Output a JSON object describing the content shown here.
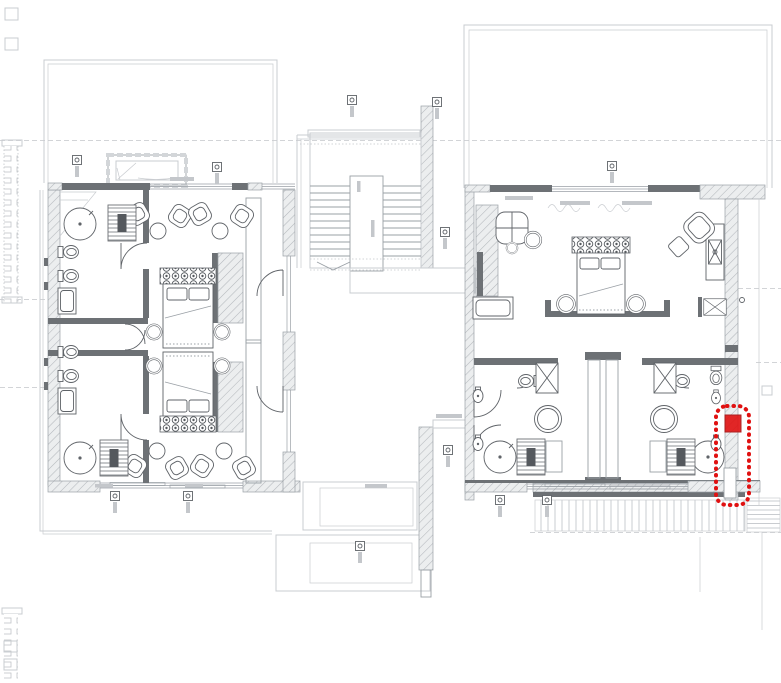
{
  "document": {
    "kind": "architectural floor plan (CAD, upper level, two bedroom wings with central staircase)",
    "background": "#ffffff"
  },
  "palette": {
    "outline_light": "#c9ccd0",
    "line_mid": "#9aa0a6",
    "wall_dark": "#6d7175",
    "hatch_line": "#b4b8bc",
    "furniture": "#5f6368",
    "dashed_ref": "#c3c6ca",
    "tag_fill": "#c4c7cb",
    "highlight_red": "#e01111"
  },
  "highlight": {
    "name": "highlighted-wall-segment",
    "style": "red dotted rounded outline with red filled marker square",
    "x": 716,
    "y": 406,
    "width": 33,
    "height": 99,
    "rx": 11,
    "marker_x": 725,
    "marker_y": 415,
    "marker_w": 16,
    "marker_h": 17
  },
  "plan": {
    "tags": [
      [
        77,
        160
      ],
      [
        217,
        167
      ],
      [
        352,
        100
      ],
      [
        437,
        102
      ],
      [
        612,
        166
      ],
      [
        445,
        232
      ],
      [
        448,
        450
      ],
      [
        115,
        496
      ],
      [
        188,
        496
      ],
      [
        360,
        546
      ],
      [
        500,
        500
      ],
      [
        547,
        500
      ]
    ],
    "chair_sets": [
      [
        160,
        222,
        0
      ],
      [
        222,
        222,
        0
      ],
      [
        155,
        460,
        180
      ],
      [
        222,
        460,
        180
      ]
    ],
    "toilets": [
      [
        70,
        252,
        -90
      ],
      [
        70,
        276,
        -90
      ],
      [
        70,
        352,
        -90
      ],
      [
        70,
        376,
        -90
      ],
      [
        527,
        381,
        90
      ],
      [
        681,
        381,
        -90
      ],
      [
        716,
        377,
        0,
        0.9
      ]
    ],
    "tubs": [
      [
        80,
        224
      ],
      [
        80,
        458
      ],
      [
        500,
        457
      ],
      [
        708,
        457
      ]
    ],
    "tables": [
      [
        548,
        419
      ],
      [
        664,
        419
      ],
      [
        154,
        332,
        0,
        0.6
      ],
      [
        222,
        332,
        0,
        0.6
      ],
      [
        154,
        366,
        0,
        0.6
      ],
      [
        222,
        366,
        0,
        0.6
      ],
      [
        566,
        304,
        0,
        0.7
      ],
      [
        636,
        304,
        0,
        0.7
      ],
      [
        533,
        240,
        0,
        0.65
      ],
      [
        512,
        248,
        0,
        0.45
      ]
    ],
    "sinks": [
      [
        478,
        396
      ],
      [
        478,
        444
      ],
      [
        716,
        398,
        0,
        0.9
      ],
      [
        716,
        444
      ]
    ],
    "xboxes": [
      [
        547,
        378
      ],
      [
        665,
        378
      ],
      [
        715,
        307,
        90,
        0.75
      ]
    ],
    "saunas": [
      [
        122,
        223
      ],
      [
        114,
        458
      ],
      [
        531,
        457
      ],
      [
        681,
        457
      ]
    ],
    "armchairs": [
      [
        695,
        232,
        -42
      ]
    ]
  }
}
